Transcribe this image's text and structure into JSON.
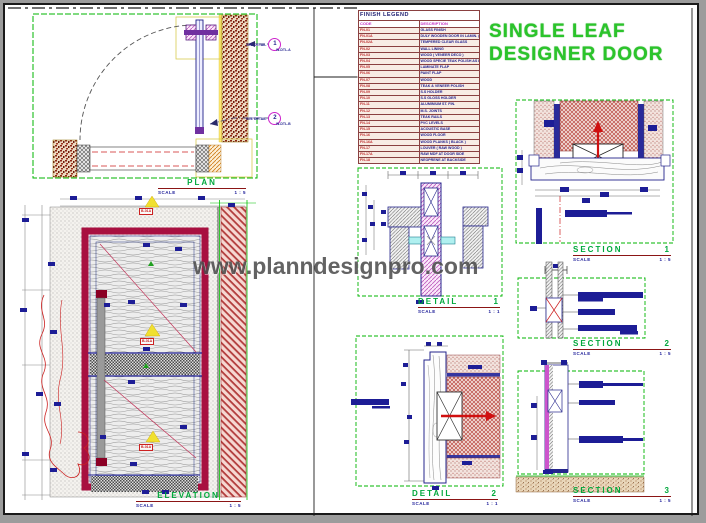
{
  "title": {
    "line1": "SINGLE LEAF",
    "line2": "DESIGNER DOOR"
  },
  "watermark": "www.planndesignpro.com",
  "labels": {
    "scale_word": "SCALE"
  },
  "legend": {
    "title": "FINISH LEGEND",
    "col_code": "CODE",
    "col_desc": "DESCRIPTION",
    "rows": [
      {
        "code": "FN-01",
        "desc": "GLASS FINISH"
      },
      {
        "code": "FN-01A",
        "desc": "DULY WOODEN DOOR IN LAMIN. (FL-01)"
      },
      {
        "code": "FN-02A",
        "desc": "TEMPERED CLEAR GLASS"
      },
      {
        "code": "FN-02",
        "desc": "WALL LINING"
      },
      {
        "code": "FN-03",
        "desc": "WOOD ( VENEER DECO )"
      },
      {
        "code": "FN-04",
        "desc": "WOOD SPECIE TEAK POLISH AS PER FINISH"
      },
      {
        "code": "FN-05",
        "desc": "LAMINATE FLAP"
      },
      {
        "code": "FN-06",
        "desc": "PAINT FLAP"
      },
      {
        "code": "FN-07",
        "desc": "WOOD"
      },
      {
        "code": "FN-08",
        "desc": "TEAK & VENEER POLISH"
      },
      {
        "code": "FN-09",
        "desc": "S.S HOLDER"
      },
      {
        "code": "FN-10",
        "desc": "S.S GLOSS HOLDER"
      },
      {
        "code": "FN-11",
        "desc": "ALUMINIUM ST. FIN."
      },
      {
        "code": "FN-12",
        "desc": "M.S. JOINTS"
      },
      {
        "code": "FN-13",
        "desc": "TEAK RAILS"
      },
      {
        "code": "FN-14",
        "desc": "PVC LEVELS"
      },
      {
        "code": "FN-15",
        "desc": "ACOUSTIC BASE"
      },
      {
        "code": "FN-16",
        "desc": "WOOD FLOOR"
      },
      {
        "code": "FN-16A",
        "desc": "WOOD PLANKS ( BLACK )"
      },
      {
        "code": "FN-17",
        "desc": "LOUVER ( RAW WOOD )"
      },
      {
        "code": "FN-17A",
        "desc": "RAW MDF AT DOOR SIDE"
      },
      {
        "code": "FN-18",
        "desc": "NEOPRENE AT BACKSIDE"
      }
    ]
  },
  "views": {
    "plan": {
      "name": "PLAN",
      "num": "",
      "scale": "1 : 5"
    },
    "elevation": {
      "name": "ELEVATION",
      "num": "",
      "scale": "1 : 5"
    },
    "detail1": {
      "name": "DETAIL",
      "num": "1",
      "scale": "1 : 1"
    },
    "detail2": {
      "name": "DETAIL",
      "num": "2",
      "scale": "1 : 1"
    },
    "section1": {
      "name": "SECTION",
      "num": "1",
      "scale": "1 : 5"
    },
    "section2": {
      "name": "SECTION",
      "num": "2",
      "scale": "1 : 5"
    },
    "section3": {
      "name": "SECTION",
      "num": "3",
      "scale": "1 : 5"
    }
  },
  "callouts": [
    {
      "lead": "SEE DETAIL",
      "num": "1",
      "ref": "W-DTL.A"
    },
    {
      "lead": "SEE DETAIL",
      "num": "2",
      "ref": "W-DTL.B"
    }
  ],
  "elevation_tags": [
    "B-01A",
    "B-01A",
    "B-01A"
  ],
  "colors": {
    "accent_green": "#00b400",
    "frame_crimson": "#a81040",
    "navy": "#1d1d96",
    "magenta": "#cc22cc",
    "maroon_rule": "#8b1515"
  }
}
